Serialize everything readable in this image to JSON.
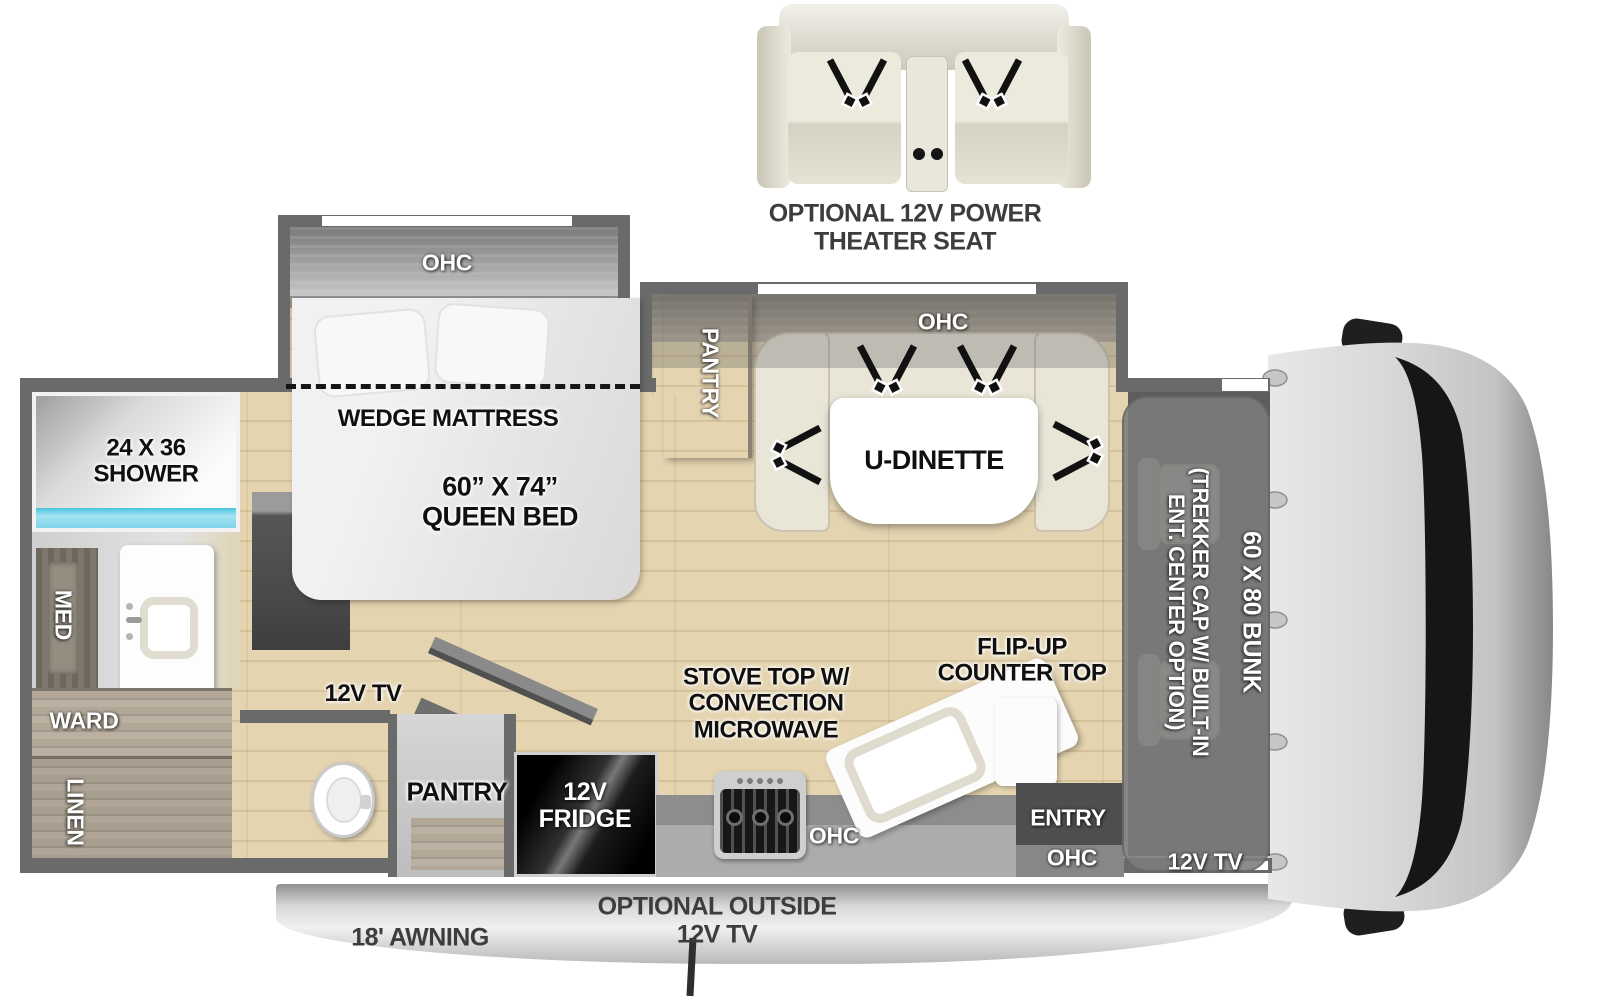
{
  "theater_seat": {
    "caption": "OPTIONAL 12V POWER\nTHEATER SEAT"
  },
  "bedroom": {
    "ohc": "OHC",
    "wedge": "WEDGE MATTRESS",
    "bed_size": "60” X 74”\nQUEEN BED"
  },
  "bathroom": {
    "shower": "24 X 36\nSHOWER",
    "med": "MED",
    "ward": "WARD",
    "linen": "LINEN"
  },
  "dinette": {
    "pantry": "PANTRY",
    "ohc": "OHC",
    "table": "U-DINETTE"
  },
  "living": {
    "tv": "12V TV"
  },
  "kitchen": {
    "pantry": "PANTRY",
    "fridge": "12V\nFRIDGE",
    "stove": "STOVE TOP W/\nCONVECTION\nMICROWAVE",
    "ohc": "OHC",
    "flip_up_counter": "FLIP-UP\nCOUNTER TOP"
  },
  "entry": {
    "door": "ENTRY",
    "ohc": "OHC"
  },
  "cab": {
    "trekker_option": "(TREKKER CAP W/ BUILT-IN\nENT. CENTER OPTION)",
    "bunk": "60 X 80 BUNK",
    "tv": "12V TV"
  },
  "exterior": {
    "awning": "18' AWNING",
    "outside_tv": "OPTIONAL OUTSIDE\n12V TV"
  },
  "colors": {
    "floor": "#e4d4b0",
    "wall": "#6a6a6a",
    "shower_water": "#8ed8ea",
    "counter": "#a9a9a9",
    "cream": "#e9e5d7",
    "label_black": "#101010",
    "label_white": "#ffffff"
  }
}
